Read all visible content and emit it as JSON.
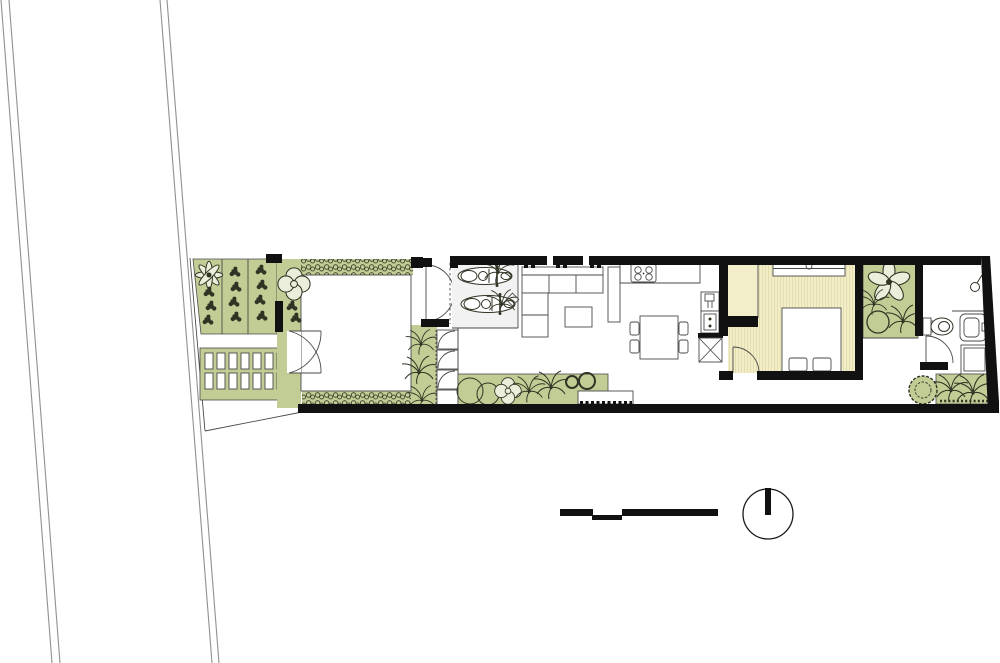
{
  "canvas": {
    "width": 1000,
    "height": 663,
    "background": "#ffffff"
  },
  "drawing": {
    "type": "architectural-floor-plan",
    "view": "ground-floor site plan of a long narrow house",
    "text_labels": []
  },
  "palette": {
    "paper": "#ffffff",
    "garden_green": "#c1cd94",
    "foliage_ink": "#2f3424",
    "wall_black": "#111111",
    "line_gray": "#4a4a4a",
    "road_gray": "#909090",
    "bedroom_beige": "#f3eeca",
    "bedroom_stripe": "#e4deae",
    "petal_light": "#eaeeda",
    "parking_gray": "#f2f2f2"
  },
  "legend": {
    "north_arrow": "north-arrow",
    "scale_bar": "graphic-scale-bar"
  },
  "site_elements": [
    "road-edges",
    "flower-bed",
    "paving-grid",
    "courtyard",
    "hedge",
    "entry-gate",
    "entry-doors",
    "scooter-parking",
    "sofa",
    "coffee-table",
    "tv-cabinet",
    "kitchen-counter",
    "cooktop",
    "sink-unit",
    "dining-table",
    "dining-chairs",
    "service-shaft",
    "planter-strip",
    "stepping-stones",
    "bench",
    "bedroom",
    "wardrobe",
    "double-bed",
    "bedroom-door",
    "rear-garden",
    "bathroom",
    "toilet",
    "washbasin",
    "shower-head",
    "shower-tray",
    "bathroom-door",
    "back-garden",
    "north-arrow",
    "scale-bar"
  ]
}
